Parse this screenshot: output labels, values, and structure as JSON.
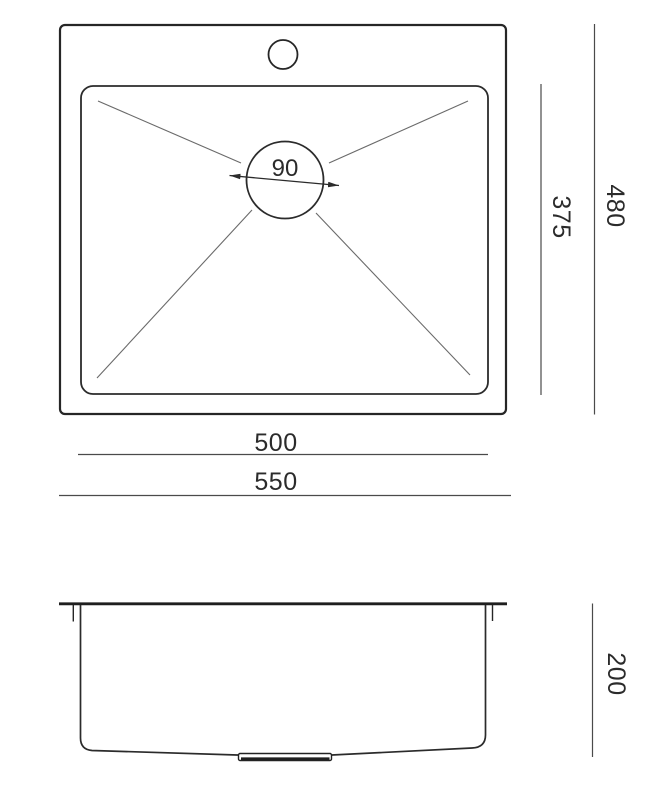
{
  "document": {
    "type": "technical_drawing",
    "subject": "top-mount kitchen sink dimensional drawing with plan (top) view and front section view"
  },
  "top_view": {
    "overall_width": "550",
    "overall_depth": "480",
    "bowl_width": "500",
    "bowl_depth": "375",
    "drain_diameter": "90"
  },
  "side_view": {
    "bowl_height": "200"
  },
  "colors": {
    "outline": "#262626",
    "dimension_line": "#4a4a4a",
    "slope_line": "#6a6a6a",
    "text": "#2b2b2b",
    "background": "#ffffff"
  }
}
